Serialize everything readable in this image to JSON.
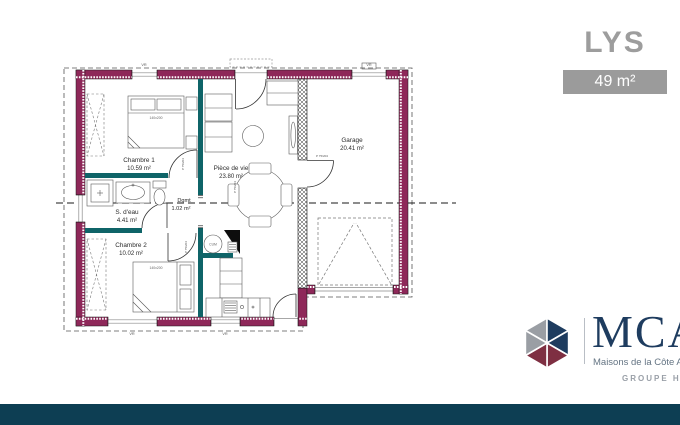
{
  "header": {
    "model_name": "LYS",
    "area_badge": "49 m²"
  },
  "plan": {
    "rooms": {
      "chambre1": {
        "name": "Chambre 1",
        "area": "10.59 m²"
      },
      "sdeau": {
        "name": "S. d'eau",
        "area": "4.41 m²"
      },
      "chambre2": {
        "name": "Chambre 2",
        "area": "10.02 m²"
      },
      "degagement": {
        "name": "Dgmt",
        "area": "1.02 m²"
      },
      "piece_de_vie": {
        "name": "Pièce de vie",
        "area": "23.80 m²"
      },
      "garage": {
        "name": "Garage",
        "area": "20.41 m²"
      }
    },
    "labels": {
      "bed1_size": "140x200",
      "bed2_size": "140x200",
      "water_heater": "CUM",
      "door_label": "P 75/204",
      "shutter": "VR"
    },
    "colors": {
      "exterior_wall": "#8e2859",
      "partition": "#0f6468"
    }
  },
  "branding": {
    "name": "MCA",
    "subtitle": "Maisons de la Côte Atlantique",
    "group": "GROUPE HEXAÔM",
    "colors": {
      "navy": "#1e3c5f",
      "maroon": "#7e2f42",
      "gray": "#9aa0a8"
    }
  },
  "footer": {
    "bar_color": "#0d3e53"
  }
}
